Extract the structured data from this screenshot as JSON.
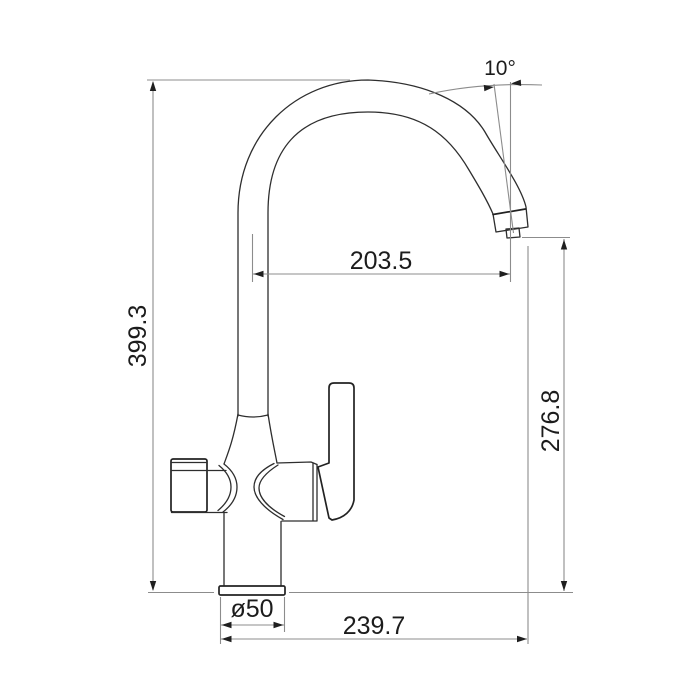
{
  "drawing": {
    "subject": "kitchen-faucet-dimension-drawing",
    "labels": {
      "overall_height": "399.3",
      "spout_reach": "203.5",
      "outlet_height": "276.8",
      "spout_angle": "10°",
      "base_diameter": "ø50",
      "overall_depth": "239.7"
    },
    "colors": {
      "background": "#ffffff",
      "faucet_outline": "#2e2e2e",
      "dimension_lines": "#8c8c8c",
      "text": "#1c1c1c"
    }
  }
}
